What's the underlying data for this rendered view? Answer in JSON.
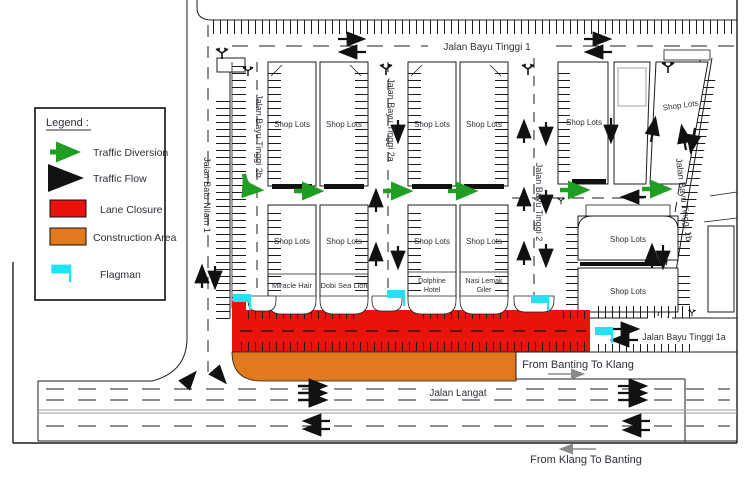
{
  "colors": {
    "lane_closure": "#e8130b",
    "construction_area": "#e2791f",
    "flagman": "#1fe3f2",
    "traffic_diversion": "#1f9e23",
    "traffic_flow": "#111111",
    "median_line": "#999999",
    "text": "#2e2e3a"
  },
  "legend": {
    "title": "Legend :",
    "items": [
      {
        "name": "traffic-diversion",
        "label": "Traffic Diversion"
      },
      {
        "name": "traffic-flow",
        "label": "Traffic Flow"
      },
      {
        "name": "lane-closure",
        "label": "Lane Closure"
      },
      {
        "name": "construction-area",
        "label": "Construction Area"
      },
      {
        "name": "flagman",
        "label": "Flagman"
      }
    ]
  },
  "streets": {
    "jalan_bayu_tinggi_1": "Jalan Bayu Tinggi 1",
    "jalan_batu_nilam_1": "Jalan Batu Nilam 1",
    "jalan_bayu_tinggi_2b": "Jalan Bayu Tinggi 2b",
    "jalan_bayu_tinggi_2a": "Jalan Bayu Tinggi 2a",
    "jalan_bayu_tinggi_2": "Jalan Bayu Tinggi 2",
    "jalan_bayu_tinggi_1b": "Jalan Bayu Tinggi 1b",
    "jalan_bayu_tinggi_1a": "Jalan Bayu Tinggi 1a",
    "jalan_langat": "Jalan Langat"
  },
  "directions": {
    "banting_to_klang": "From Banting To Klang",
    "klang_to_banting": "From Klang To Banting"
  },
  "labels": {
    "shop_lots": "Shop Lots"
  },
  "businesses": {
    "miracle_hair": "Miracle Hair",
    "dobi_sea_lion": "Dobi Sea Lion",
    "dolphine_hotel_line1": "Dolphine",
    "dolphine_hotel_line2": "Hotel",
    "nasi_lemak_line1": "Nasi Lemak",
    "nasi_lemak_line2": "Giler"
  }
}
